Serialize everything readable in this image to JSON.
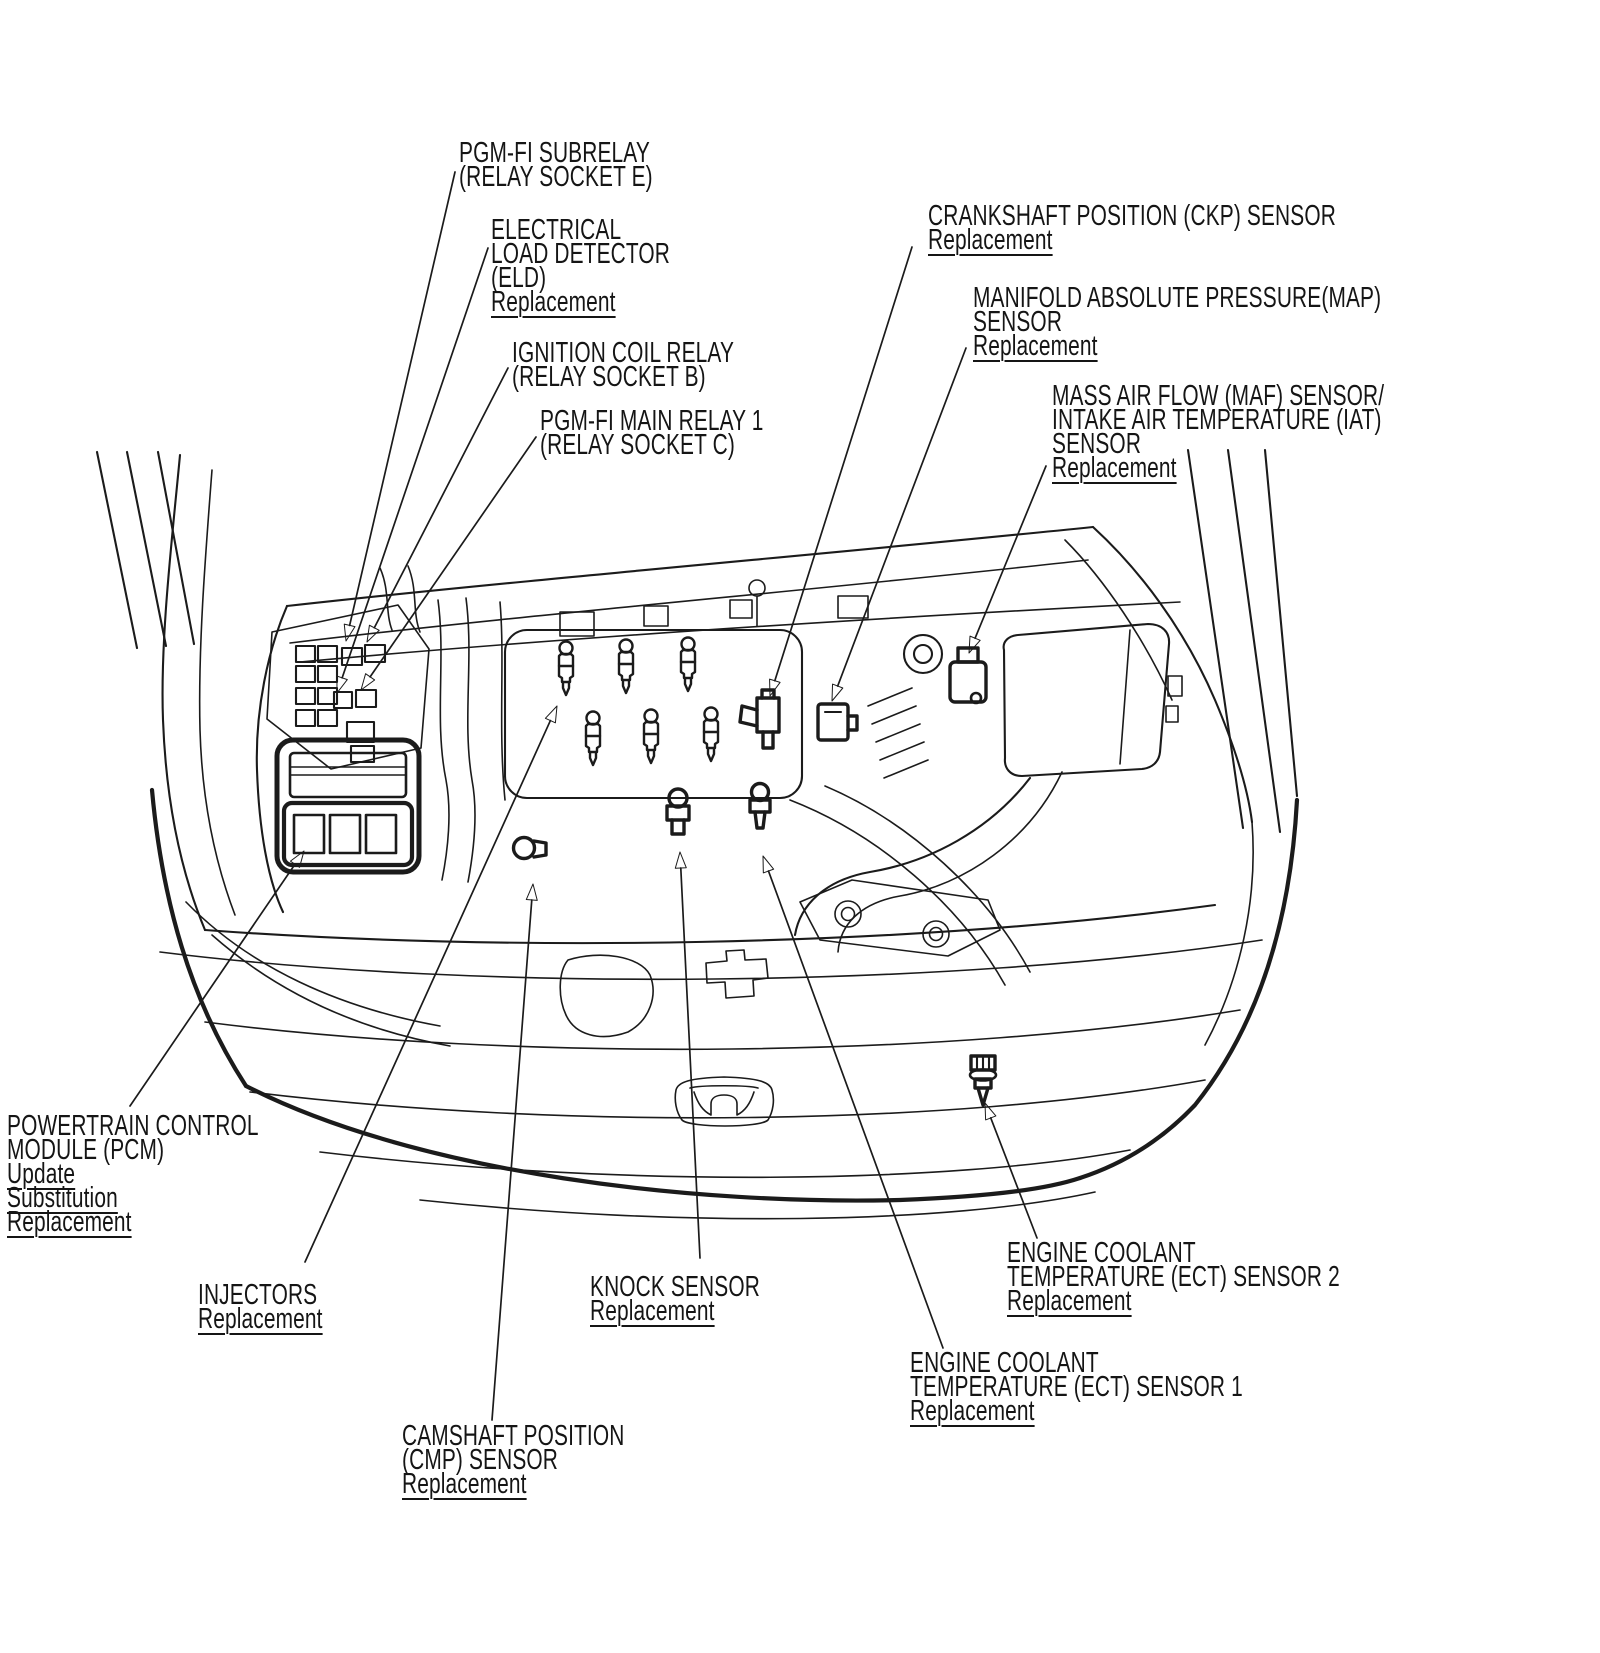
{
  "figure": {
    "background_color": "#ffffff",
    "line_color": "#1b1b1b"
  },
  "labels": [
    {
      "id": "pgm-fi-subrelay",
      "x": 459,
      "y": 141,
      "lines": [
        {
          "text": "PGM-FI SUBRELAY",
          "underlined": false
        },
        {
          "text": "(RELAY SOCKET E)",
          "underlined": false
        }
      ]
    },
    {
      "id": "eld",
      "x": 491,
      "y": 218,
      "lines": [
        {
          "text": "ELECTRICAL",
          "underlined": false
        },
        {
          "text": "LOAD DETECTOR",
          "underlined": false
        },
        {
          "text": "(ELD)",
          "underlined": false
        },
        {
          "text": "Replacement",
          "underlined": true
        }
      ]
    },
    {
      "id": "ignition-coil-relay",
      "x": 512,
      "y": 341,
      "lines": [
        {
          "text": "IGNITION COIL RELAY",
          "underlined": false
        },
        {
          "text": "(RELAY SOCKET B)",
          "underlined": false
        }
      ]
    },
    {
      "id": "pgm-fi-main-relay-1",
      "x": 540,
      "y": 409,
      "lines": [
        {
          "text": "PGM-FI MAIN RELAY 1",
          "underlined": false
        },
        {
          "text": "(RELAY SOCKET C)",
          "underlined": false
        }
      ]
    },
    {
      "id": "ckp-sensor",
      "x": 928,
      "y": 204,
      "lines": [
        {
          "text": "CRANKSHAFT POSITION (CKP) SENSOR",
          "underlined": false
        },
        {
          "text": "Replacement",
          "underlined": true
        }
      ]
    },
    {
      "id": "map-sensor",
      "x": 973,
      "y": 286,
      "lines": [
        {
          "text": "MANIFOLD ABSOLUTE PRESSURE(MAP)",
          "underlined": false
        },
        {
          "text": "SENSOR",
          "underlined": false
        },
        {
          "text": "Replacement",
          "underlined": true
        }
      ]
    },
    {
      "id": "maf-iat-sensor",
      "x": 1052,
      "y": 384,
      "lines": [
        {
          "text": "MASS AIR FLOW (MAF) SENSOR/",
          "underlined": false
        },
        {
          "text": "INTAKE AIR TEMPERATURE (IAT)",
          "underlined": false
        },
        {
          "text": "SENSOR",
          "underlined": false
        },
        {
          "text": "Replacement",
          "underlined": true
        }
      ]
    },
    {
      "id": "pcm",
      "x": 7,
      "y": 1114,
      "lines": [
        {
          "text": "POWERTRAIN CONTROL",
          "underlined": false
        },
        {
          "text": "MODULE (PCM)",
          "underlined": false
        },
        {
          "text": "Update",
          "underlined": true
        },
        {
          "text": "Substitution",
          "underlined": true
        },
        {
          "text": "Replacement",
          "underlined": true
        }
      ]
    },
    {
      "id": "injectors",
      "x": 198,
      "y": 1283,
      "lines": [
        {
          "text": "INJECTORS",
          "underlined": false
        },
        {
          "text": "Replacement",
          "underlined": true
        }
      ]
    },
    {
      "id": "knock-sensor",
      "x": 590,
      "y": 1275,
      "lines": [
        {
          "text": "KNOCK SENSOR",
          "underlined": false
        },
        {
          "text": "Replacement",
          "underlined": true
        }
      ]
    },
    {
      "id": "cmp-sensor",
      "x": 402,
      "y": 1424,
      "lines": [
        {
          "text": "CAMSHAFT POSITION",
          "underlined": false
        },
        {
          "text": "(CMP) SENSOR",
          "underlined": false
        },
        {
          "text": "Replacement",
          "underlined": true
        }
      ]
    },
    {
      "id": "ect-sensor-2",
      "x": 1007,
      "y": 1241,
      "lines": [
        {
          "text": "ENGINE COOLANT",
          "underlined": false
        },
        {
          "text": "TEMPERATURE (ECT) SENSOR 2",
          "underlined": false
        },
        {
          "text": "Replacement",
          "underlined": true
        }
      ]
    },
    {
      "id": "ect-sensor-1",
      "x": 910,
      "y": 1351,
      "lines": [
        {
          "text": "ENGINE COOLANT",
          "underlined": false
        },
        {
          "text": "TEMPERATURE (ECT) SENSOR 1",
          "underlined": false
        },
        {
          "text": "Replacement",
          "underlined": true
        }
      ]
    }
  ],
  "leaders": [
    {
      "label_id": "pgm-fi-subrelay",
      "from": [
        455,
        172
      ],
      "to": [
        346,
        641
      ]
    },
    {
      "label_id": "eld",
      "from": [
        488,
        248
      ],
      "to": [
        337,
        693
      ]
    },
    {
      "label_id": "ignition-coil-relay",
      "from": [
        508,
        368
      ],
      "to": [
        367,
        642
      ]
    },
    {
      "label_id": "pgm-fi-main-relay-1",
      "from": [
        536,
        437
      ],
      "to": [
        361,
        690
      ]
    },
    {
      "label_id": "ckp-sensor",
      "from": [
        912,
        247
      ],
      "to": [
        770,
        696
      ]
    },
    {
      "label_id": "map-sensor",
      "from": [
        966,
        348
      ],
      "to": [
        832,
        701
      ]
    },
    {
      "label_id": "maf-iat-sensor",
      "from": [
        1046,
        466
      ],
      "to": [
        969,
        653
      ]
    },
    {
      "label_id": "pcm",
      "from": [
        130,
        1106
      ],
      "to": [
        304,
        851
      ]
    },
    {
      "label_id": "injectors",
      "from": [
        305,
        1262
      ],
      "to": [
        557,
        706
      ]
    },
    {
      "label_id": "knock-sensor",
      "from": [
        700,
        1258
      ],
      "to": [
        680,
        852
      ]
    },
    {
      "label_id": "cmp-sensor",
      "from": [
        492,
        1420
      ],
      "to": [
        533,
        884
      ]
    },
    {
      "label_id": "ect-sensor-1",
      "from": [
        943,
        1348
      ],
      "to": [
        763,
        856
      ]
    },
    {
      "label_id": "ect-sensor-2",
      "from": [
        1037,
        1238
      ],
      "to": [
        985,
        1103
      ]
    }
  ]
}
